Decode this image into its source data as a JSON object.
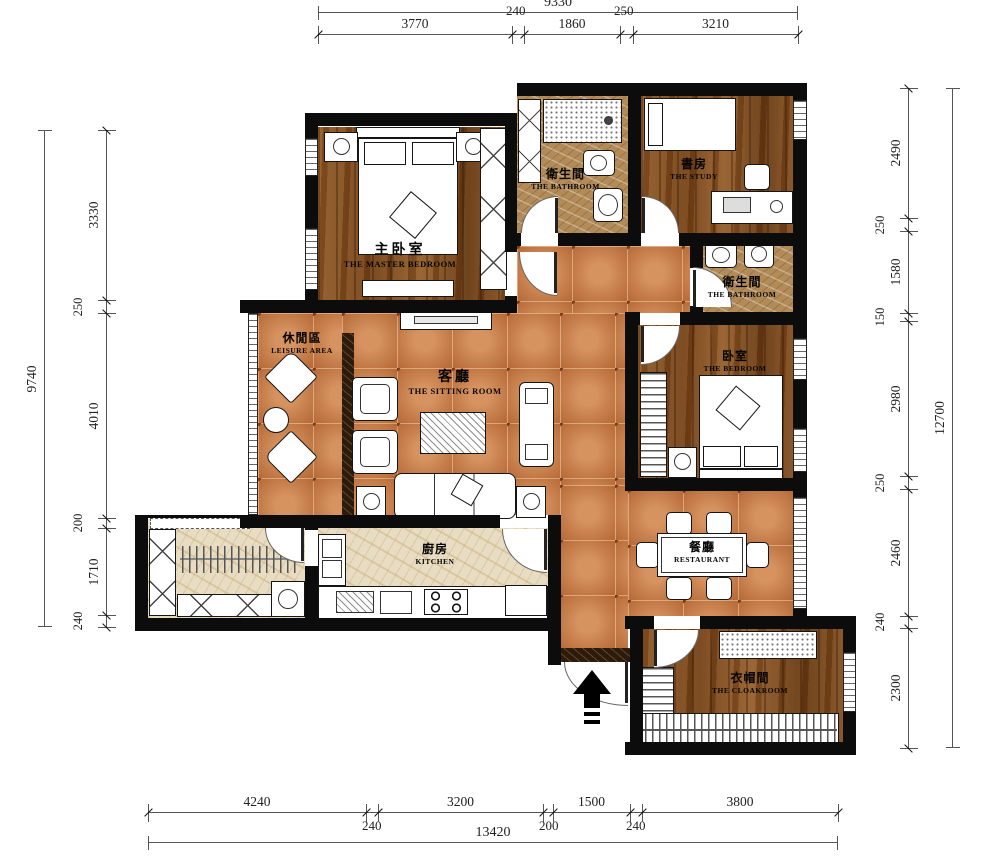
{
  "dimensions": {
    "top": {
      "total": "9330",
      "segments": [
        "3770",
        "240",
        "1860",
        "250",
        "3210"
      ]
    },
    "left": {
      "total": "9740",
      "segments": [
        "3330",
        "250",
        "4010",
        "200",
        "1710",
        "240"
      ]
    },
    "right": {
      "total": "12700",
      "segments": [
        "2490",
        "250",
        "1580",
        "150",
        "2980",
        "250",
        "2460",
        "240",
        "2300"
      ]
    },
    "bottom": {
      "total": "13420",
      "segments": [
        "4240",
        "240",
        "3200",
        "200",
        "1500",
        "240",
        "3800"
      ]
    }
  },
  "rooms": {
    "master_bedroom": {
      "zh": "主卧室",
      "en": "THE MASTER BEDROOM"
    },
    "bathroom_top": {
      "zh": "衛生間",
      "en": "THE BATHROOM"
    },
    "study": {
      "zh": "書房",
      "en": "THE STUDY"
    },
    "bathroom_right": {
      "zh": "衛生間",
      "en": "THE BATHROOM"
    },
    "bedroom": {
      "zh": "卧室",
      "en": "THE BEDROOM"
    },
    "leisure_area": {
      "zh": "休閒區",
      "en": "LEISURE AREA"
    },
    "sitting_room": {
      "zh": "客廳",
      "en": "THE SITTING ROOM"
    },
    "kitchen": {
      "zh": "廚房",
      "en": "KITCHEN"
    },
    "restaurant": {
      "zh": "餐廳",
      "en": "RESTAURANT"
    },
    "cloakroom": {
      "zh": "衣帽間",
      "en": "THE CLOAKROOM"
    }
  },
  "colors": {
    "wall": "#0c0c0c",
    "tile_floor": "#ca7c45",
    "wood_floor": "#7a4a20",
    "bath_floor": "#b28b58",
    "kitchen_floor": "#e8dcc2",
    "threshold": "#2c1a0c"
  }
}
